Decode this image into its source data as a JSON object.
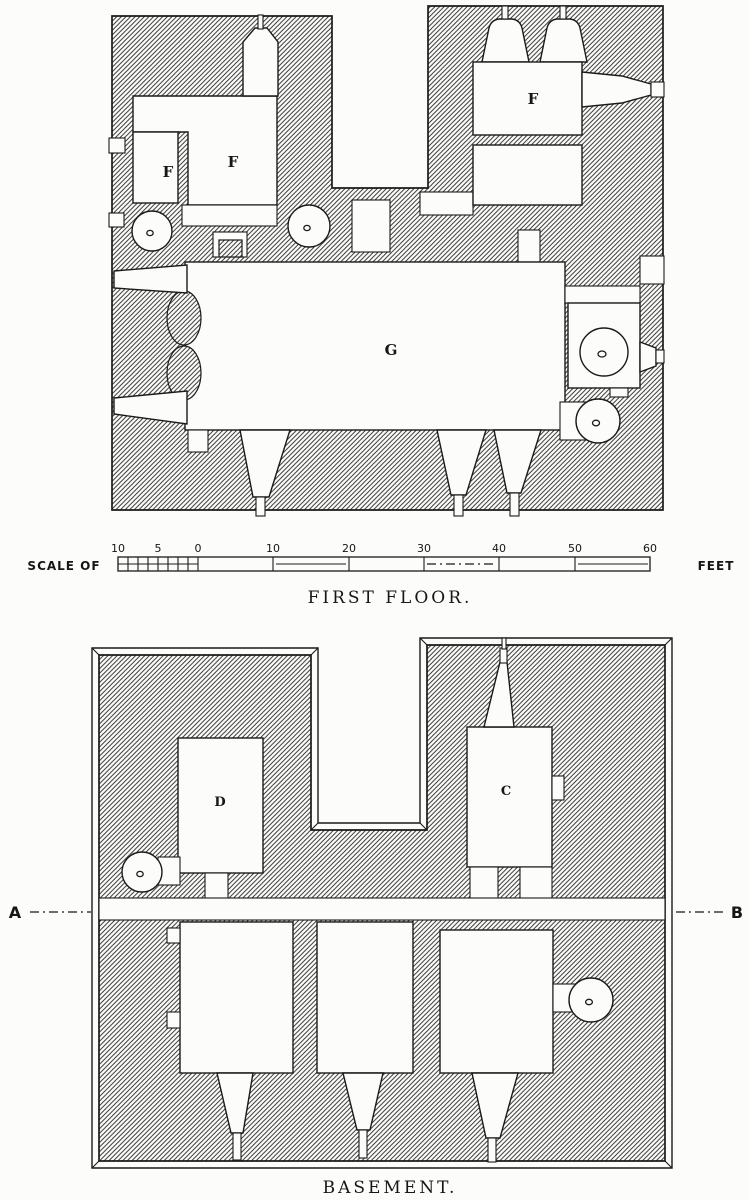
{
  "page": {
    "background": "#fcfcfa",
    "ink": "#1a1a1a"
  },
  "first_floor": {
    "caption": "FIRST FLOOR.",
    "room_labels": {
      "closet_f": "F",
      "hall_f": "F",
      "northeast_f": "F",
      "great_hall_g": "G"
    }
  },
  "scale_bar": {
    "prefix": "SCALE OF",
    "unit": "FEET",
    "ticks": [
      "10",
      "5",
      "0",
      "10",
      "20",
      "30",
      "40",
      "50",
      "60"
    ]
  },
  "basement": {
    "caption": "BASEMENT.",
    "room_labels": {
      "cellar_d": "D",
      "cellar_c": "C"
    },
    "section_markers": {
      "left": "A",
      "right": "B"
    }
  }
}
